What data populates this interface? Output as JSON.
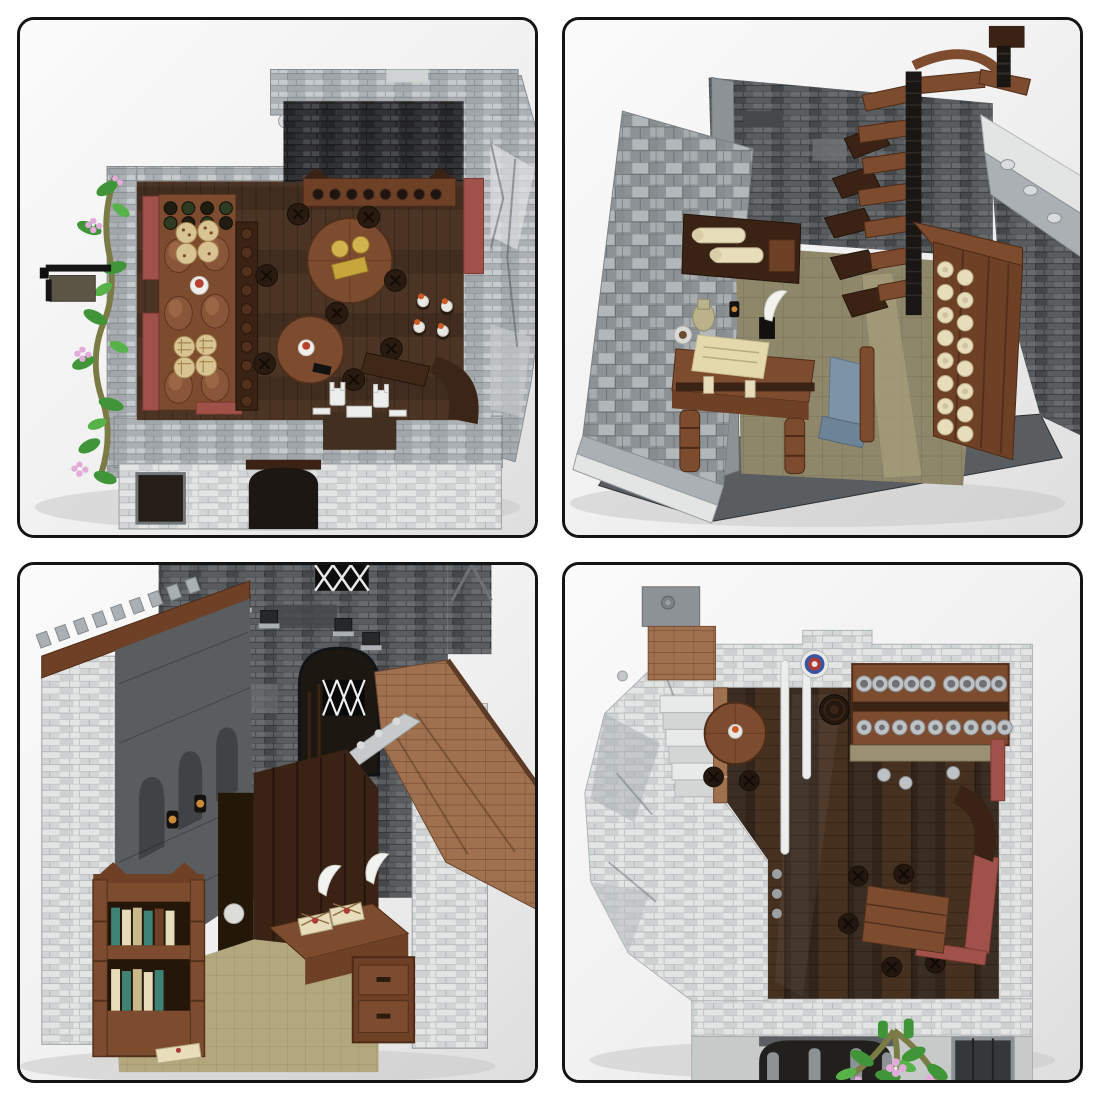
{
  "page": {
    "background": "#ffffff"
  },
  "gallery": {
    "layout": "2x2 photo grid of LEGO-style medieval tavern interior renders",
    "tiles": [
      {
        "id": "dining-room-top-view",
        "alt": "Top-down view of stone tavern dining room: food counter with roast turkeys, pies and waffles, round tables with stools, red benches, flowering vines on the outer wall"
      },
      {
        "id": "scriptorium-spiral-staircase",
        "alt": "Cutaway room with wooden spiral staircase, scroll rack of cream parchments, writing desk with quill, ink pot and jug, cobblestone walk on the left"
      },
      {
        "id": "study-library-cutaway",
        "alt": "Cutaway castle study: bookshelf with colored books, desk with wax-sealed letters and quills, lattice windows, arched doorway, battlements and brown roof"
      },
      {
        "id": "bar-room-top-view",
        "alt": "Top-down view of tavern bar room: shelves of silver tankards and goblets, dartboard, round table with candle, red benches, stairs, flowering plant at the entrance arch"
      }
    ]
  },
  "palette": {
    "page_bg": "#ffffff",
    "tile_border": "#141414",
    "brick_light": "#abb0b4",
    "brick_white": "#e3e5e5",
    "brick_mid": "#8d9296",
    "brick_dark": "#595d60",
    "brick_darker": "#3a3d40",
    "wall_near_black": "#313234",
    "floor_dark": "#32241a",
    "floor_brown": "#4b3424",
    "wood_red": "#6e4026",
    "wood_mid": "#7d4b2e",
    "wood_dark": "#3a2314",
    "nougat": "#a0714e",
    "tan": "#d8c492",
    "dark_tan": "#8f8769",
    "cream": "#e7ddbb",
    "sand_red": "#a0524a",
    "green": "#3f9538",
    "green_light": "#58b24a",
    "olive": "#7b7b46",
    "pink": "#e2abd9",
    "sand_blue": "#7d93a6",
    "silver": "#bfc2c4",
    "silver_dark": "#6e7276",
    "yellow": "#d2b44e",
    "orange": "#cf5a22",
    "black_piece": "#1c1915",
    "white_piece": "#eceded",
    "dart_blue": "#3a55a0",
    "dart_red": "#ad3a35",
    "amber": "#c98a3a"
  }
}
